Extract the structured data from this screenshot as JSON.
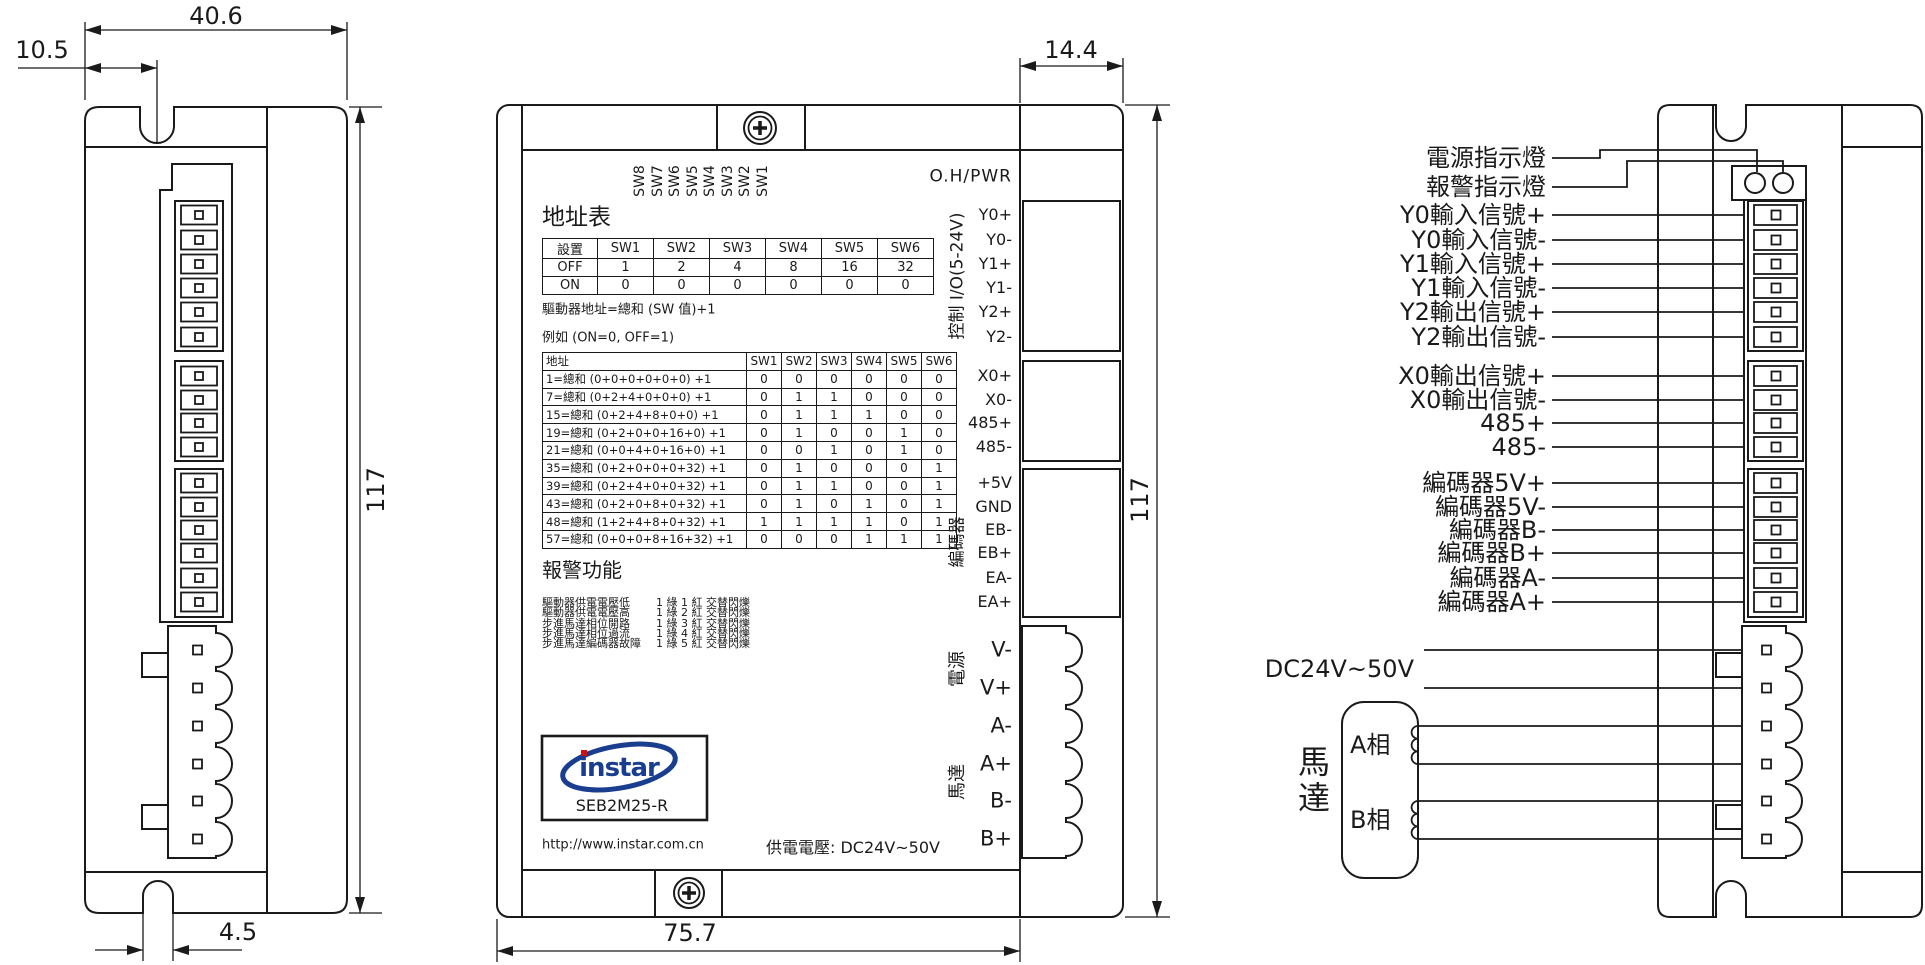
{
  "left_view": {
    "dim_width": "40.6",
    "dim_notch_offset": "10.5",
    "dim_height": "117",
    "dim_slot": "4.5"
  },
  "front_view": {
    "dim_depth": "14.4",
    "dim_height": "117",
    "dim_width": "75.7",
    "top_right_label": "O.H/PWR",
    "dip_switch_labels": [
      "SW8",
      "SW7",
      "SW6",
      "SW5",
      "SW4",
      "SW3",
      "SW2",
      "SW1"
    ],
    "address_section": {
      "title": "地址表",
      "switch_table": {
        "headers": [
          "設置",
          "SW1",
          "SW2",
          "SW3",
          "SW4",
          "SW5",
          "SW6"
        ],
        "rows": [
          [
            "OFF",
            "1",
            "2",
            "4",
            "8",
            "16",
            "32"
          ],
          [
            "ON",
            "0",
            "0",
            "0",
            "0",
            "0",
            "0"
          ]
        ]
      },
      "formula": "驅動器地址=總和 (SW 值)+1",
      "example": "例如 (ON=0, OFF=1)",
      "example_table": {
        "headers": [
          "地址",
          "SW1",
          "SW2",
          "SW3",
          "SW4",
          "SW5",
          "SW6"
        ],
        "rows": [
          [
            "1=總和 (0+0+0+0+0+0) +1",
            "0",
            "0",
            "0",
            "0",
            "0",
            "0"
          ],
          [
            "7=總和 (0+2+4+0+0+0) +1",
            "0",
            "1",
            "1",
            "0",
            "0",
            "0"
          ],
          [
            "15=總和 (0+2+4+8+0+0) +1",
            "0",
            "1",
            "1",
            "1",
            "0",
            "0"
          ],
          [
            "19=總和 (0+2+0+0+16+0) +1",
            "0",
            "1",
            "0",
            "0",
            "1",
            "0"
          ],
          [
            "21=總和 (0+0+4+0+16+0) +1",
            "0",
            "0",
            "1",
            "0",
            "1",
            "0"
          ],
          [
            "35=總和 (0+2+0+0+0+32) +1",
            "0",
            "1",
            "0",
            "0",
            "0",
            "1"
          ],
          [
            "39=總和 (0+2+4+0+0+32) +1",
            "0",
            "1",
            "1",
            "0",
            "0",
            "1"
          ],
          [
            "43=總和 (0+2+0+8+0+32) +1",
            "0",
            "1",
            "0",
            "1",
            "0",
            "1"
          ],
          [
            "48=總和 (1+2+4+8+0+32) +1",
            "1",
            "1",
            "1",
            "1",
            "0",
            "1"
          ],
          [
            "57=總和 (0+0+0+8+16+32) +1",
            "0",
            "0",
            "0",
            "1",
            "1",
            "1"
          ]
        ]
      }
    },
    "alarm_section": {
      "title": "報警功能",
      "items": [
        {
          "condition": "驅動器供電電壓低",
          "signal": "1 綠 1 紅  交替閃爍"
        },
        {
          "condition": "驅動器供電電壓高",
          "signal": "1 綠 2 紅  交替閃爍"
        },
        {
          "condition": "步進馬達相位開路",
          "signal": "1 綠 3 紅  交替閃爍"
        },
        {
          "condition": "步進馬達相位過流",
          "signal": "1 綠 4 紅  交替閃爍"
        },
        {
          "condition": "步進馬達編碼器故障",
          "signal": "1 綠 5 紅  交替閃爍"
        }
      ]
    },
    "logo": {
      "brand": "instar",
      "model": "SEB2M25-R",
      "url": "http://www.instar.com.cn",
      "brand_color": "#1a3e8f",
      "dot_color": "#cc1111"
    },
    "supply_voltage": "供電電壓: DC24V~50V",
    "connector_groups": {
      "io": {
        "label": "控制 I/O(5-24V)",
        "pins": [
          "Y0+",
          "Y0-",
          "Y1+",
          "Y1-",
          "Y2+",
          "Y2-"
        ]
      },
      "comm_pins": [
        "X0+",
        "X0-",
        "485+",
        "485-"
      ],
      "encoder": {
        "label": "編碼器",
        "pins": [
          "+5V",
          "GND",
          "EB-",
          "EB+",
          "EA-",
          "EA+"
        ]
      },
      "power": {
        "label": "電源",
        "pins": [
          "V-",
          "V+"
        ]
      },
      "motor": {
        "label": "馬達",
        "pins": [
          "A-",
          "A+",
          "B-",
          "B+"
        ]
      }
    }
  },
  "right_view": {
    "wire_labels": [
      "電源指示燈",
      "報警指示燈",
      "Y0輸入信號+",
      "Y0輸入信號-",
      "Y1輸入信號+",
      "Y1輸入信號-",
      "Y2輸出信號+",
      "Y2輸出信號-",
      "X0輸出信號+",
      "X0輸出信號-",
      "485+",
      "485-",
      "編碼器5V+",
      "編碼器5V-",
      "編碼器B-",
      "編碼器B+",
      "編碼器A-",
      "編碼器A+"
    ],
    "supply_label": "DC24V~50V",
    "motor_label": "馬達",
    "phase_a": "A相",
    "phase_b": "B相"
  }
}
